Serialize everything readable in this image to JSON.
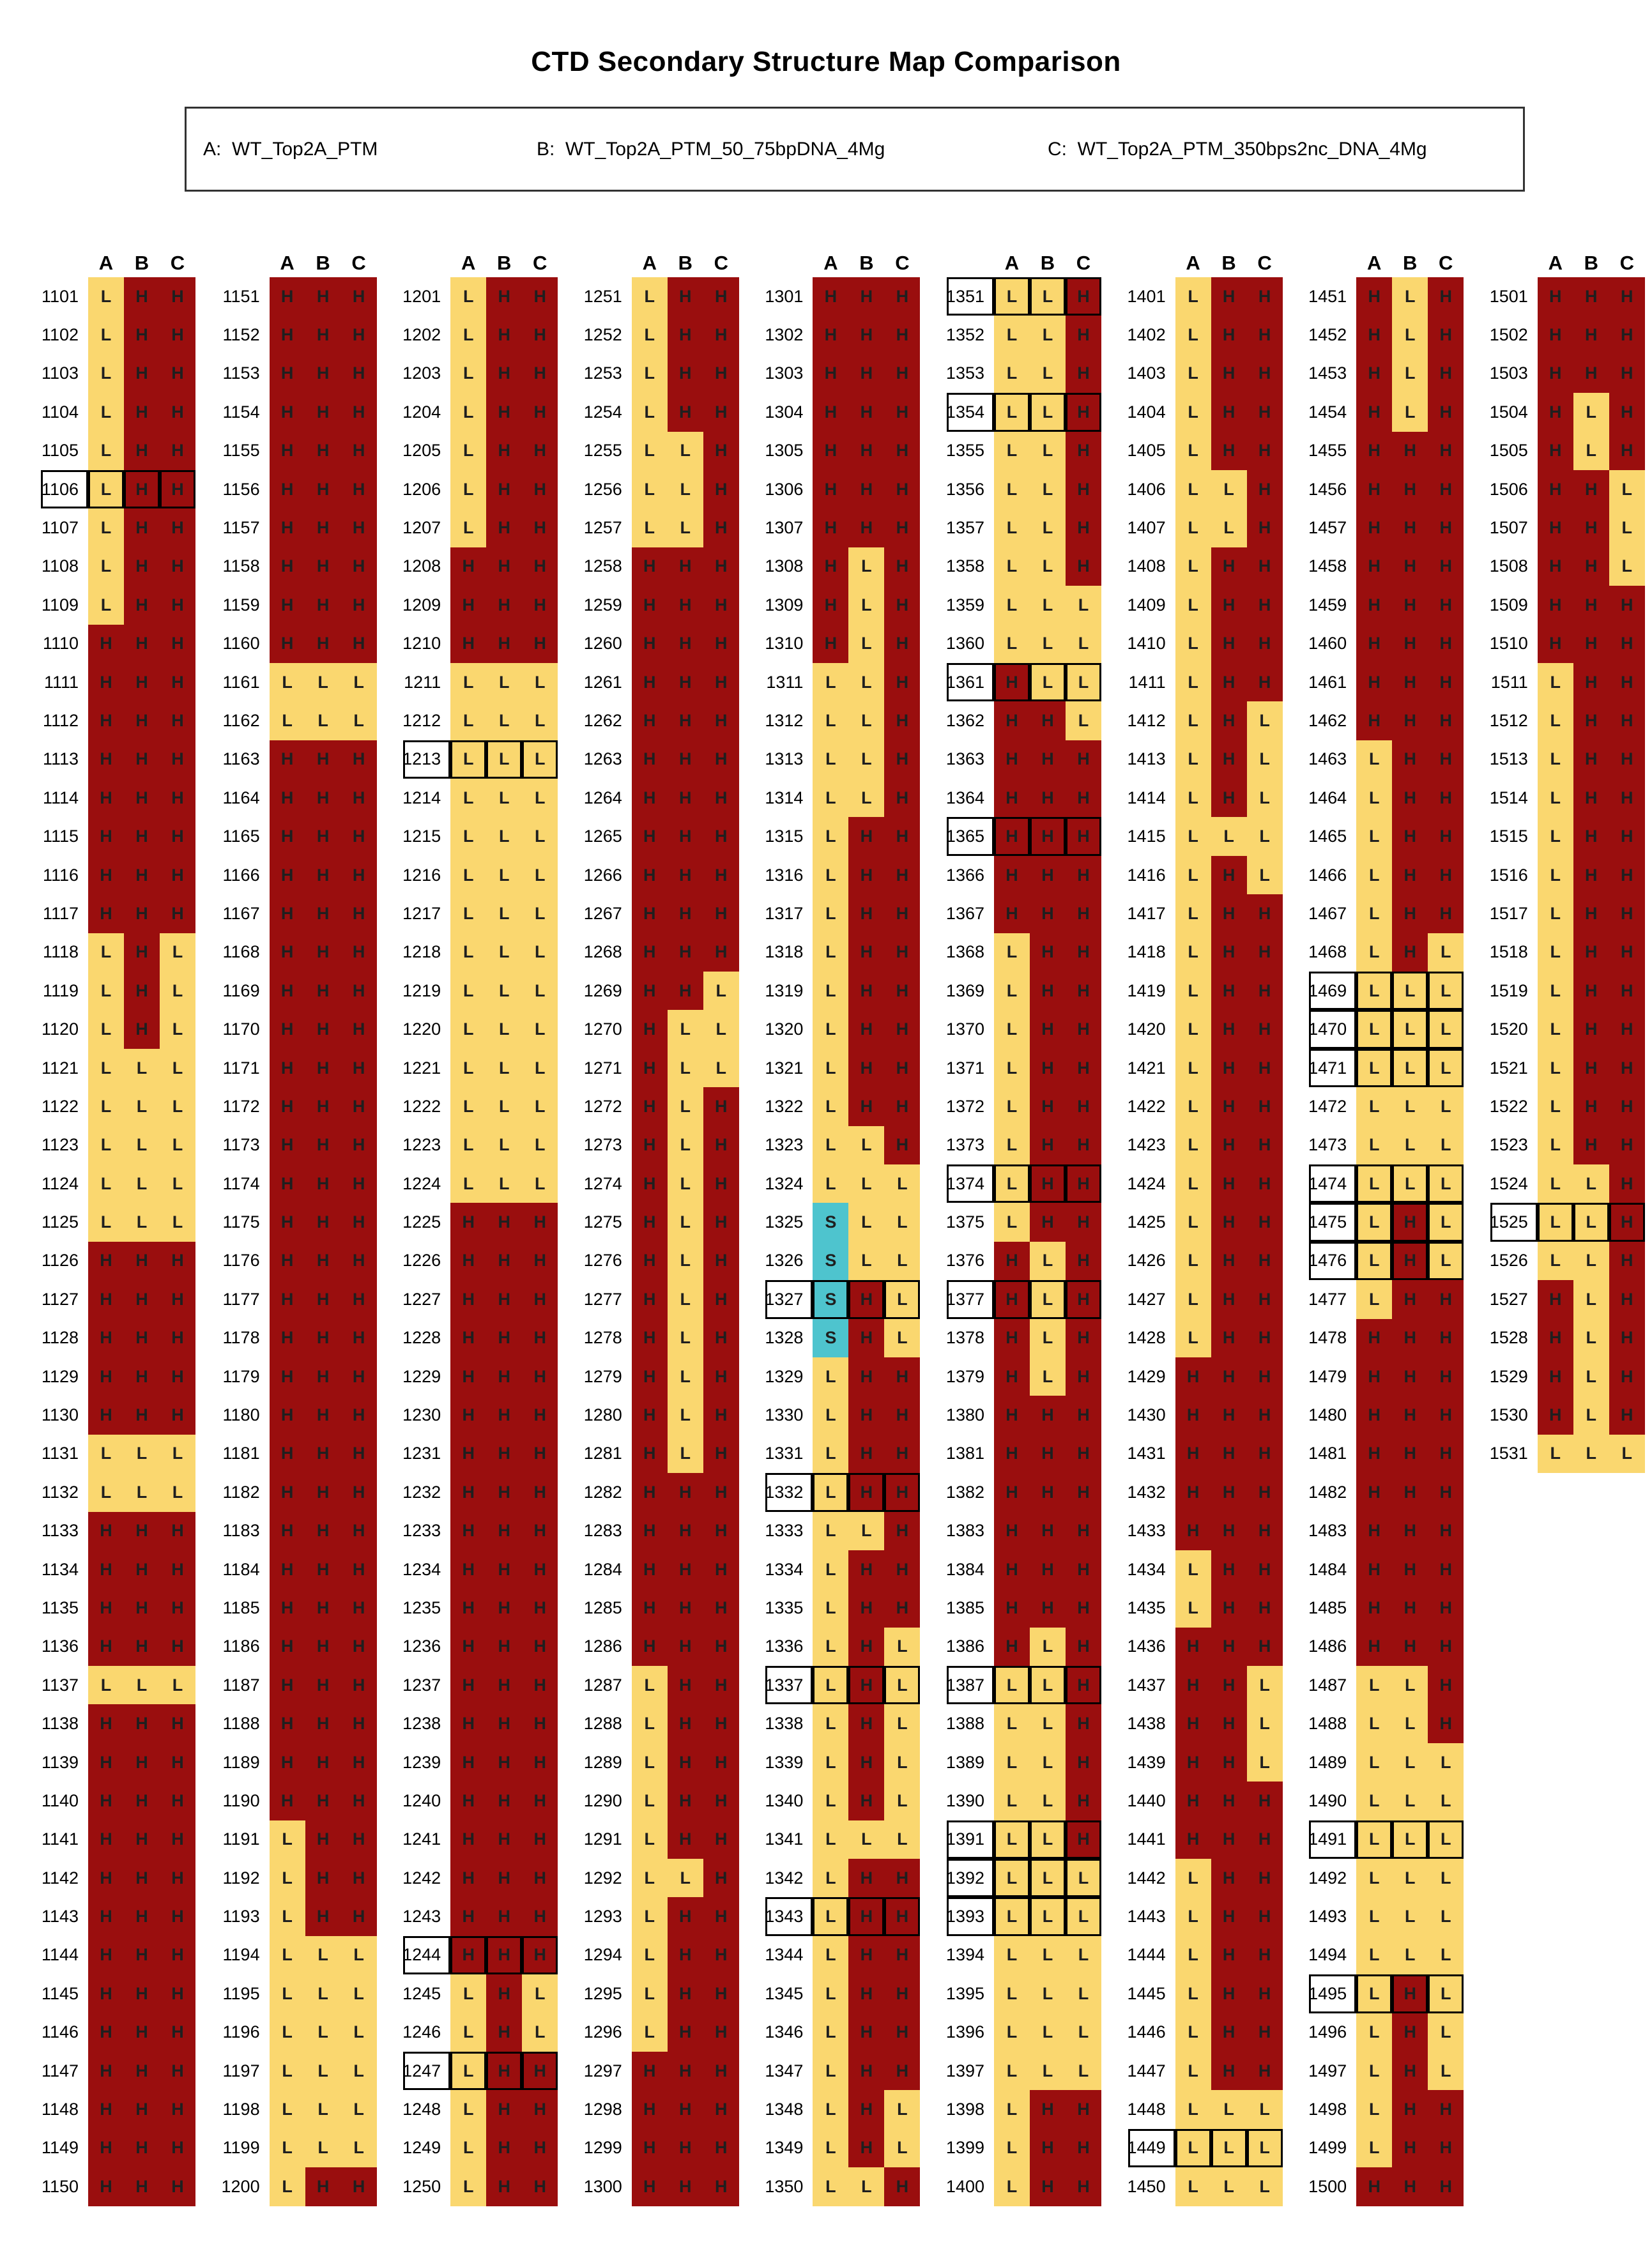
{
  "chart_data": {
    "type": "heatmap",
    "title": "CTD Secondary Structure Map Comparison",
    "legend_items": [
      "A:  WT_Top2A_PTM",
      "B:  WT_Top2A_PTM_50_75bpDNA_4Mg",
      "C:  WT_Top2A_PTM_350bps2nc_DNA_4Mg"
    ],
    "col_header": [
      "A",
      "B",
      "C"
    ],
    "residue_start": 1101,
    "residue_end": 1531,
    "state_colors": {
      "H": "#9A0E0E",
      "L": "#FAD76F",
      "S": "#4EC4CE"
    },
    "boxed_residues": [
      1106,
      1213,
      1244,
      1247,
      1327,
      1332,
      1337,
      1343,
      1351,
      1354,
      1361,
      1365,
      1374,
      1377,
      1387,
      1391,
      1392,
      1393,
      1449,
      1469,
      1470,
      1471,
      1474,
      1475,
      1476,
      1491,
      1495,
      1525
    ],
    "columns": [
      {
        "start": 1101,
        "states": [
          "LHH",
          "LHH",
          "LHH",
          "LHH",
          "LHH",
          "LHH",
          "LHH",
          "LHH",
          "LHH",
          "HHH",
          "HHH",
          "HHH",
          "HHH",
          "HHH",
          "HHH",
          "HHH",
          "HHH",
          "LHL",
          "LHL",
          "LHL",
          "LLL",
          "LLL",
          "LLL",
          "LLL",
          "LLL",
          "HHH",
          "HHH",
          "HHH",
          "HHH",
          "HHH",
          "LLL",
          "LLL",
          "HHH",
          "HHH",
          "HHH",
          "HHH",
          "LLL",
          "HHH",
          "HHH",
          "HHH",
          "HHH",
          "HHH",
          "HHH",
          "HHH",
          "HHH",
          "HHH",
          "HHH",
          "HHH",
          "HHH",
          "HHH"
        ]
      },
      {
        "start": 1151,
        "states": [
          "HHH",
          "HHH",
          "HHH",
          "HHH",
          "HHH",
          "HHH",
          "HHH",
          "HHH",
          "HHH",
          "HHH",
          "LLL",
          "LLL",
          "HHH",
          "HHH",
          "HHH",
          "HHH",
          "HHH",
          "HHH",
          "HHH",
          "HHH",
          "HHH",
          "HHH",
          "HHH",
          "HHH",
          "HHH",
          "HHH",
          "HHH",
          "HHH",
          "HHH",
          "HHH",
          "HHH",
          "HHH",
          "HHH",
          "HHH",
          "HHH",
          "HHH",
          "HHH",
          "HHH",
          "HHH",
          "HHH",
          "LHH",
          "LHH",
          "LHH",
          "LLL",
          "LLL",
          "LLL",
          "LLL",
          "LLL",
          "LLL",
          "LHH"
        ]
      },
      {
        "start": 1201,
        "states": [
          "LHH",
          "LHH",
          "LHH",
          "LHH",
          "LHH",
          "LHH",
          "LHH",
          "HHH",
          "HHH",
          "HHH",
          "LLL",
          "LLL",
          "LLL",
          "LLL",
          "LLL",
          "LLL",
          "LLL",
          "LLL",
          "LLL",
          "LLL",
          "LLL",
          "LLL",
          "LLL",
          "LLL",
          "HHH",
          "HHH",
          "HHH",
          "HHH",
          "HHH",
          "HHH",
          "HHH",
          "HHH",
          "HHH",
          "HHH",
          "HHH",
          "HHH",
          "HHH",
          "HHH",
          "HHH",
          "HHH",
          "HHH",
          "HHH",
          "HHH",
          "HHH",
          "LHL",
          "LHL",
          "LHH",
          "LHH",
          "LHH",
          "LHH"
        ]
      },
      {
        "start": 1251,
        "states": [
          "LHH",
          "LHH",
          "LHH",
          "LHH",
          "LLH",
          "LLH",
          "LLH",
          "HHH",
          "HHH",
          "HHH",
          "HHH",
          "HHH",
          "HHH",
          "HHH",
          "HHH",
          "HHH",
          "HHH",
          "HHH",
          "HHL",
          "HLL",
          "HLL",
          "HLH",
          "HLH",
          "HLH",
          "HLH",
          "HLH",
          "HLH",
          "HLH",
          "HLH",
          "HLH",
          "HLH",
          "HHH",
          "HHH",
          "HHH",
          "HHH",
          "HHH",
          "LHH",
          "LHH",
          "LHH",
          "LHH",
          "LHH",
          "LLH",
          "LHH",
          "LHH",
          "LHH",
          "LHH",
          "HHH",
          "HHH",
          "HHH",
          "HHH"
        ]
      },
      {
        "start": 1301,
        "states": [
          "HHH",
          "HHH",
          "HHH",
          "HHH",
          "HHH",
          "HHH",
          "HHH",
          "HLH",
          "HLH",
          "HLH",
          "LLH",
          "LLH",
          "LLH",
          "LLH",
          "LHH",
          "LHH",
          "LHH",
          "LHH",
          "LHH",
          "LHH",
          "LHH",
          "LHH",
          "LLH",
          "LLL",
          "SLL",
          "SLL",
          "SHL",
          "SHL",
          "LHH",
          "LHH",
          "LHH",
          "LHH",
          "LLH",
          "LHH",
          "LHH",
          "LHL",
          "LHL",
          "LHL",
          "LHL",
          "LHL",
          "LLL",
          "LHH",
          "LHH",
          "LHH",
          "LHH",
          "LHH",
          "LHH",
          "LHL",
          "LHL",
          "LLH"
        ]
      },
      {
        "start": 1351,
        "states": [
          "LLH",
          "LLH",
          "LLH",
          "LLH",
          "LLH",
          "LLH",
          "LLH",
          "LLH",
          "LLL",
          "LLL",
          "HLL",
          "HHL",
          "HHH",
          "HHH",
          "HHH",
          "HHH",
          "HHH",
          "LHH",
          "LHH",
          "LHH",
          "LHH",
          "LHH",
          "LHH",
          "LHH",
          "LHH",
          "HLH",
          "HLH",
          "HLH",
          "HLH",
          "HHH",
          "HHH",
          "HHH",
          "HHH",
          "HHH",
          "HHH",
          "HLH",
          "LLH",
          "LLH",
          "LLH",
          "LLH",
          "LLH",
          "LLL",
          "LLL",
          "LLL",
          "LLL",
          "LLL",
          "LLL",
          "LHH",
          "LHH",
          "LHH"
        ]
      },
      {
        "start": 1401,
        "states": [
          "LHH",
          "LHH",
          "LHH",
          "LHH",
          "LHH",
          "LLH",
          "LLH",
          "LHH",
          "LHH",
          "LHH",
          "LHH",
          "LHL",
          "LHL",
          "LHL",
          "LLL",
          "LHL",
          "LHH",
          "LHH",
          "LHH",
          "LHH",
          "LHH",
          "LHH",
          "LHH",
          "LHH",
          "LHH",
          "LHH",
          "LHH",
          "LHH",
          "HHH",
          "HHH",
          "HHH",
          "HHH",
          "HHH",
          "LHH",
          "LHH",
          "HHH",
          "HHL",
          "HHL",
          "HHL",
          "HHH",
          "HHH",
          "LHH",
          "LHH",
          "LHH",
          "LHH",
          "LHH",
          "LHH",
          "LLL",
          "LLL",
          "LLL"
        ]
      },
      {
        "start": 1451,
        "states": [
          "HLH",
          "HLH",
          "HLH",
          "HLH",
          "HHH",
          "HHH",
          "HHH",
          "HHH",
          "HHH",
          "HHH",
          "HHH",
          "HHH",
          "LHH",
          "LHH",
          "LHH",
          "LHH",
          "LHH",
          "LHL",
          "LLL",
          "LLL",
          "LLL",
          "LLL",
          "LLL",
          "LLL",
          "LHL",
          "LHL",
          "LHH",
          "HHH",
          "HHH",
          "HHH",
          "HHH",
          "HHH",
          "HHH",
          "HHH",
          "HHH",
          "HHH",
          "LLH",
          "LLH",
          "LLL",
          "LLL",
          "LLL",
          "LLL",
          "LLL",
          "LLL",
          "LHL",
          "LHL",
          "LHL",
          "LHH",
          "LHH",
          "HHH"
        ]
      },
      {
        "start": 1501,
        "states": [
          "HHH",
          "HHH",
          "HHH",
          "HLH",
          "HLH",
          "HHL",
          "HHL",
          "HHL",
          "HHH",
          "HHH",
          "LHH",
          "LHH",
          "LHH",
          "LHH",
          "LHH",
          "LHH",
          "LHH",
          "LHH",
          "LHH",
          "LHH",
          "LHH",
          "LHH",
          "LHH",
          "LLH",
          "LLH",
          "LLH",
          "HLH",
          "HLH",
          "HLH",
          "HLH",
          "LLL"
        ]
      }
    ],
    "layout": {
      "group_left_start": 64,
      "group_pitch": 283.6,
      "row_height": 60.4
    }
  }
}
